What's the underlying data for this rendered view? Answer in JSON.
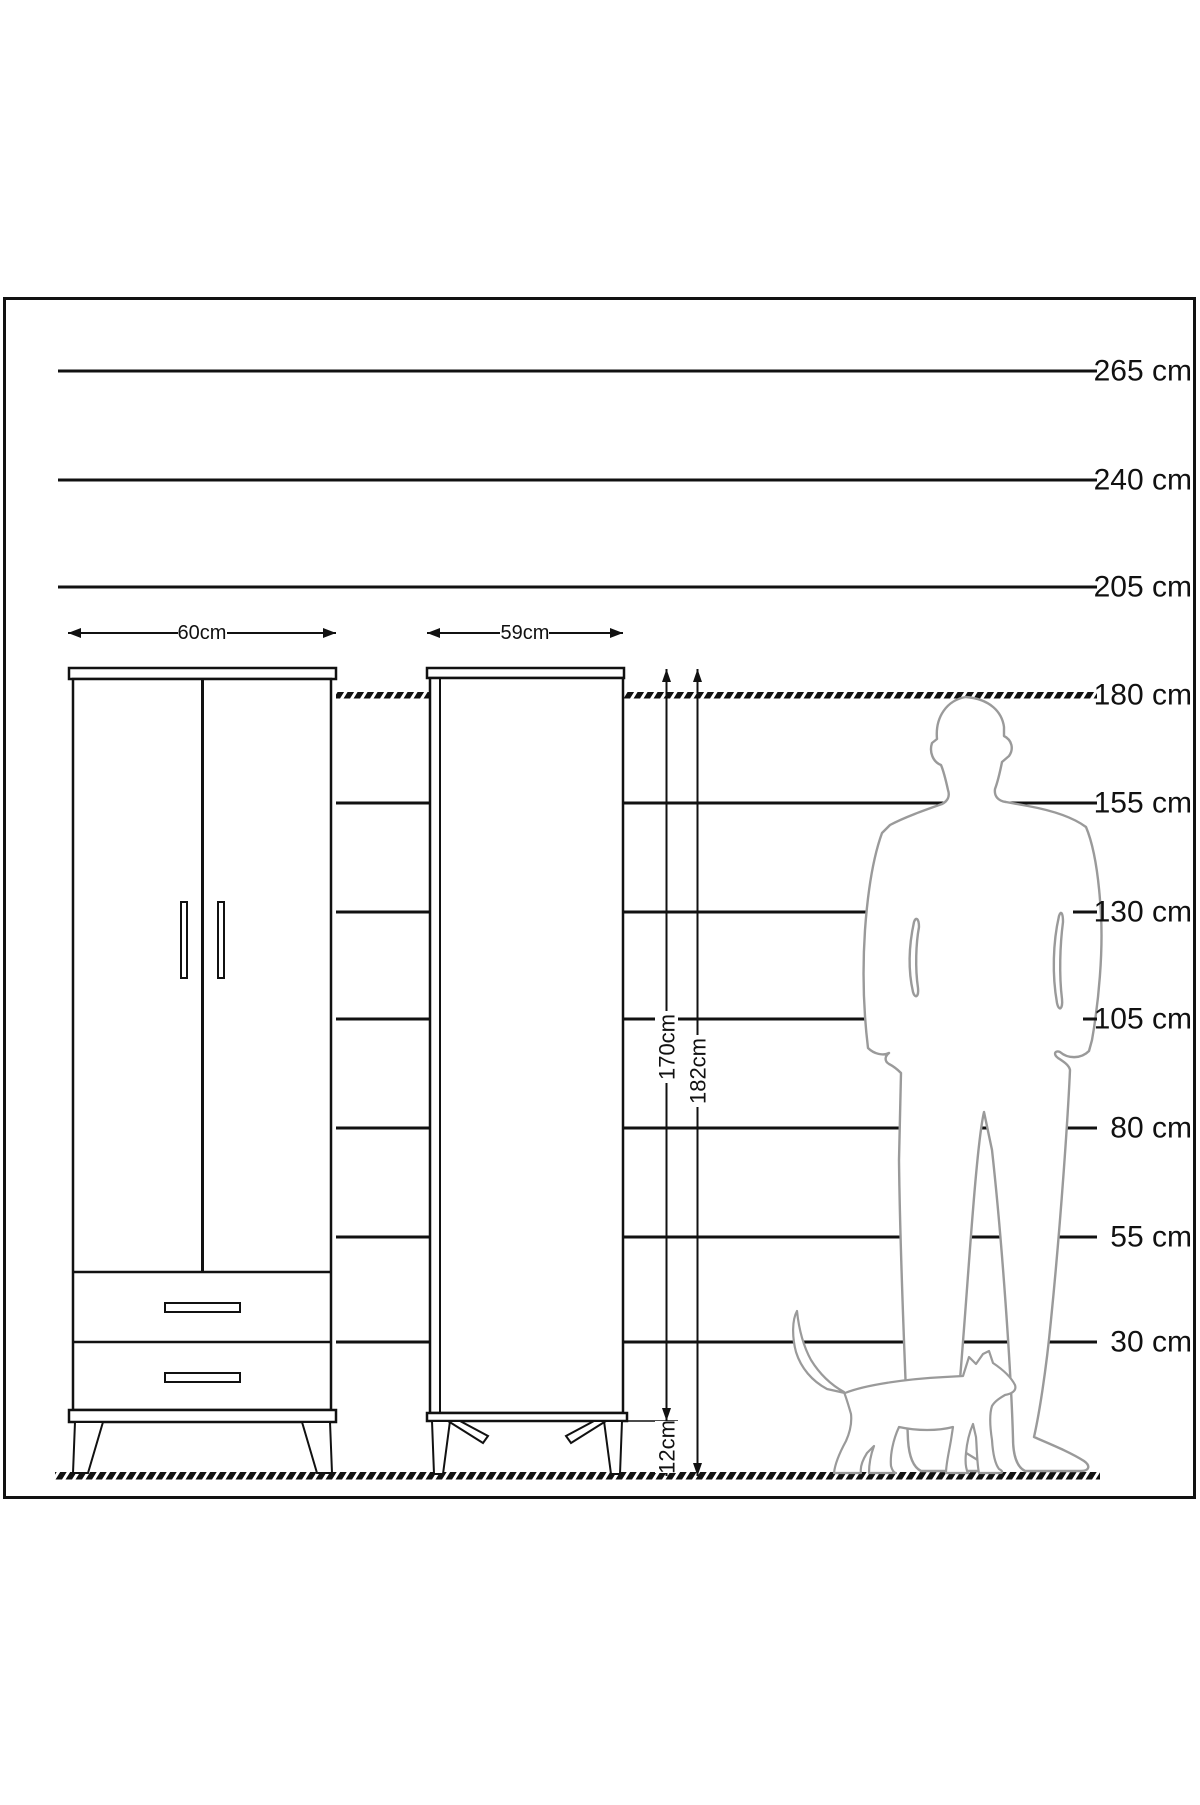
{
  "scale": {
    "labels": [
      "265 cm",
      "240 cm",
      "205 cm",
      "180 cm",
      "155 cm",
      "130 cm",
      "105 cm",
      "80 cm",
      "55 cm",
      "30 cm"
    ]
  },
  "dimensions": {
    "wardrobe_left_width": "60cm",
    "wardrobe_right_width": "59cm",
    "wardrobe_right_body_height": "170cm",
    "wardrobe_right_leg_height": "12cm",
    "wardrobe_right_total_height": "182cm"
  },
  "colors": {
    "line": "#111111",
    "silhouette_outline": "#9a9a9a",
    "background": "#ffffff"
  }
}
